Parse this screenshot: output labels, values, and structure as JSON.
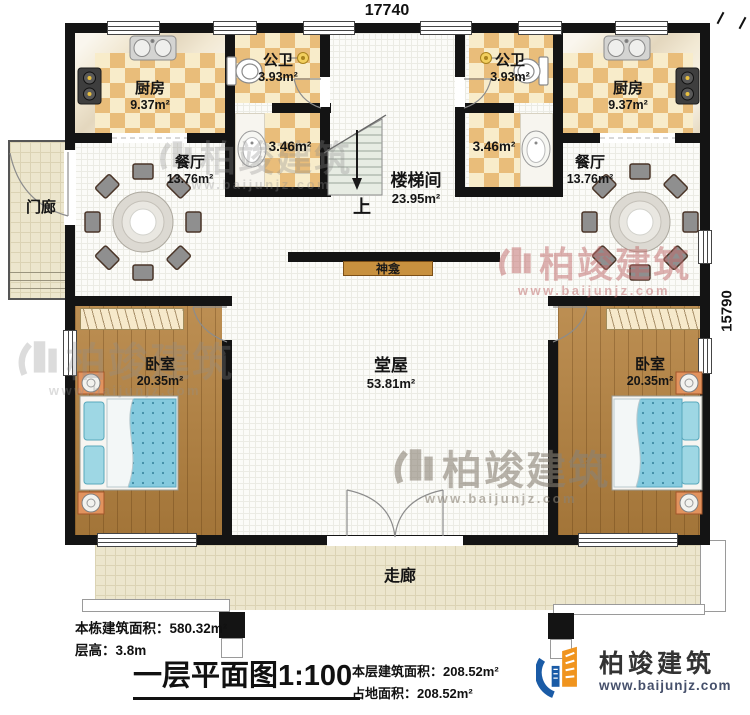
{
  "dimensions": {
    "top": "17740",
    "right": "15790"
  },
  "rooms": {
    "kitchen_left": {
      "name": "厨房",
      "area": "9.37m²"
    },
    "kitchen_right": {
      "name": "厨房",
      "area": "9.37m²"
    },
    "bath_left": {
      "name": "公卫",
      "area": "3.93m²"
    },
    "bath_right": {
      "name": "公卫",
      "area": "3.93m²"
    },
    "wash_left": {
      "area": "3.46m²"
    },
    "wash_right": {
      "area": "3.46m²"
    },
    "dining_left": {
      "name": "餐厅",
      "area": "13.76m²"
    },
    "dining_right": {
      "name": "餐厅",
      "area": "13.76m²"
    },
    "stairwell": {
      "name": "楼梯间",
      "area": "23.95m²",
      "up": "上"
    },
    "hall": {
      "name": "堂屋",
      "area": "53.81m²"
    },
    "bedroom_left": {
      "name": "卧室",
      "area": "20.35m²"
    },
    "bedroom_right": {
      "name": "卧室",
      "area": "20.35m²"
    },
    "porch": {
      "name": "门廊"
    },
    "corridor": {
      "name": "走廊"
    },
    "shrine": {
      "name": "神龛"
    }
  },
  "info": {
    "building_area_label": "本栋建筑面积：",
    "building_area_value": "580.32m²",
    "floor_height_label": "层高：",
    "floor_height_value": "3.8m",
    "plan_title": "一层平面图1:100",
    "floor_area_label": "本层建筑面积：",
    "floor_area_value": "208.52m²",
    "land_area_label": "占地面积：",
    "land_area_value": "208.52m²"
  },
  "brand": {
    "name": "柏竣建筑",
    "url": "www.baijunjz.com"
  },
  "watermark": {
    "name": "柏竣建筑",
    "url": "www.baijunjz.com"
  },
  "colors": {
    "wall": "#141414",
    "checker": "#e9bd7a",
    "wood": "#b5823f",
    "mattress": "#85cade",
    "accent_orange": "#f0941e",
    "accent_blue": "#1a5ba6"
  }
}
